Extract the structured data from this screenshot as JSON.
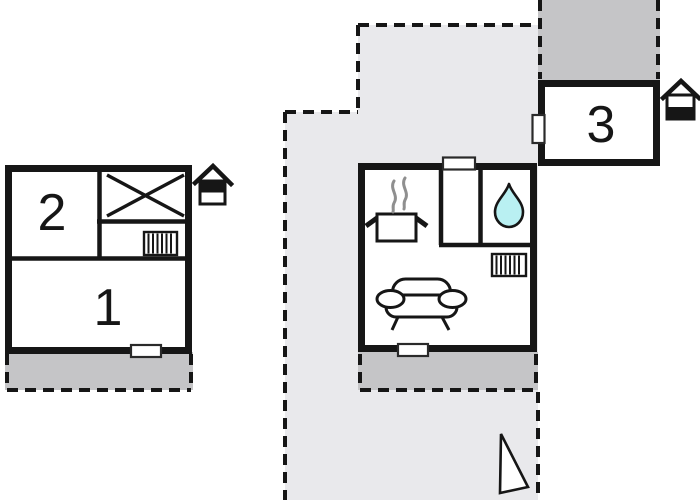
{
  "diagram": {
    "type": "floor-plan",
    "rooms": {
      "r1": {
        "label": "1"
      },
      "r2": {
        "label": "2"
      },
      "r3": {
        "label": "3"
      }
    },
    "buildings": [
      {
        "name": "apartment-house-left",
        "room_labels": [
          "2",
          "1"
        ],
        "features": [
          "x-mark",
          "radiator",
          "entrance-door",
          "terrace",
          "house-marker-top-filled"
        ]
      },
      {
        "name": "main-unit-center",
        "features": [
          "cooking-pot",
          "steam",
          "shower-water-drop",
          "window",
          "radiator",
          "sofa",
          "entrance-door",
          "terrace"
        ]
      },
      {
        "name": "apartment-house-right",
        "room_labels": [
          "3"
        ],
        "features": [
          "window",
          "terrace",
          "house-marker-bottom-filled"
        ]
      }
    ],
    "markers": [
      "north-triangle"
    ],
    "colors": {
      "background": "#ffffff",
      "interior": "#ffffff",
      "wall": "#161616",
      "plot_fill": "#e9e9ec",
      "terrace_fill": "#c5c5c7",
      "water_drop": "#b9f0f2",
      "steam": "#8f8f8f"
    }
  }
}
